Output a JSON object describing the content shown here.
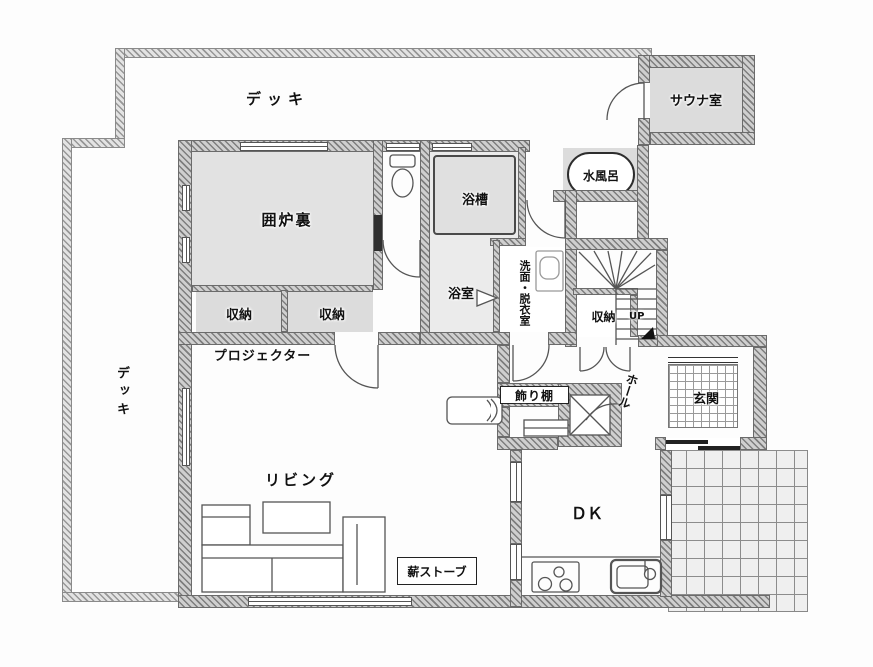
{
  "plan": {
    "type": "japanese-floor-plan",
    "labels": {
      "deck_top": "デッキ",
      "deck_left": "デッキ",
      "sauna": "サウナ室",
      "cold_bath": "水風呂",
      "irori": "囲炉裏",
      "bathtub": "浴槽",
      "bathroom": "浴室",
      "washroom": "洗面・脱衣室",
      "closet_a": "収納",
      "closet_b": "収納",
      "closet_stairs": "収納",
      "projector": "プロジェクター",
      "living": "リビング",
      "display_shelf": "飾り棚",
      "hall": "ホール",
      "entrance": "玄関",
      "dk": "ＤＫ",
      "wood_stove": "薪ストーブ",
      "up": "UP"
    },
    "colors": {
      "wall_hatch_dark": "#7e7e7e",
      "wall_hatch_light": "#cfcfcf",
      "deck_hatch": "#979797",
      "room_gray": "#e2e2e2",
      "closet_gray": "#dcdcdc",
      "bath_gray": "#ebebeb",
      "tile_gray": "#efefef",
      "line": "#555555"
    }
  }
}
